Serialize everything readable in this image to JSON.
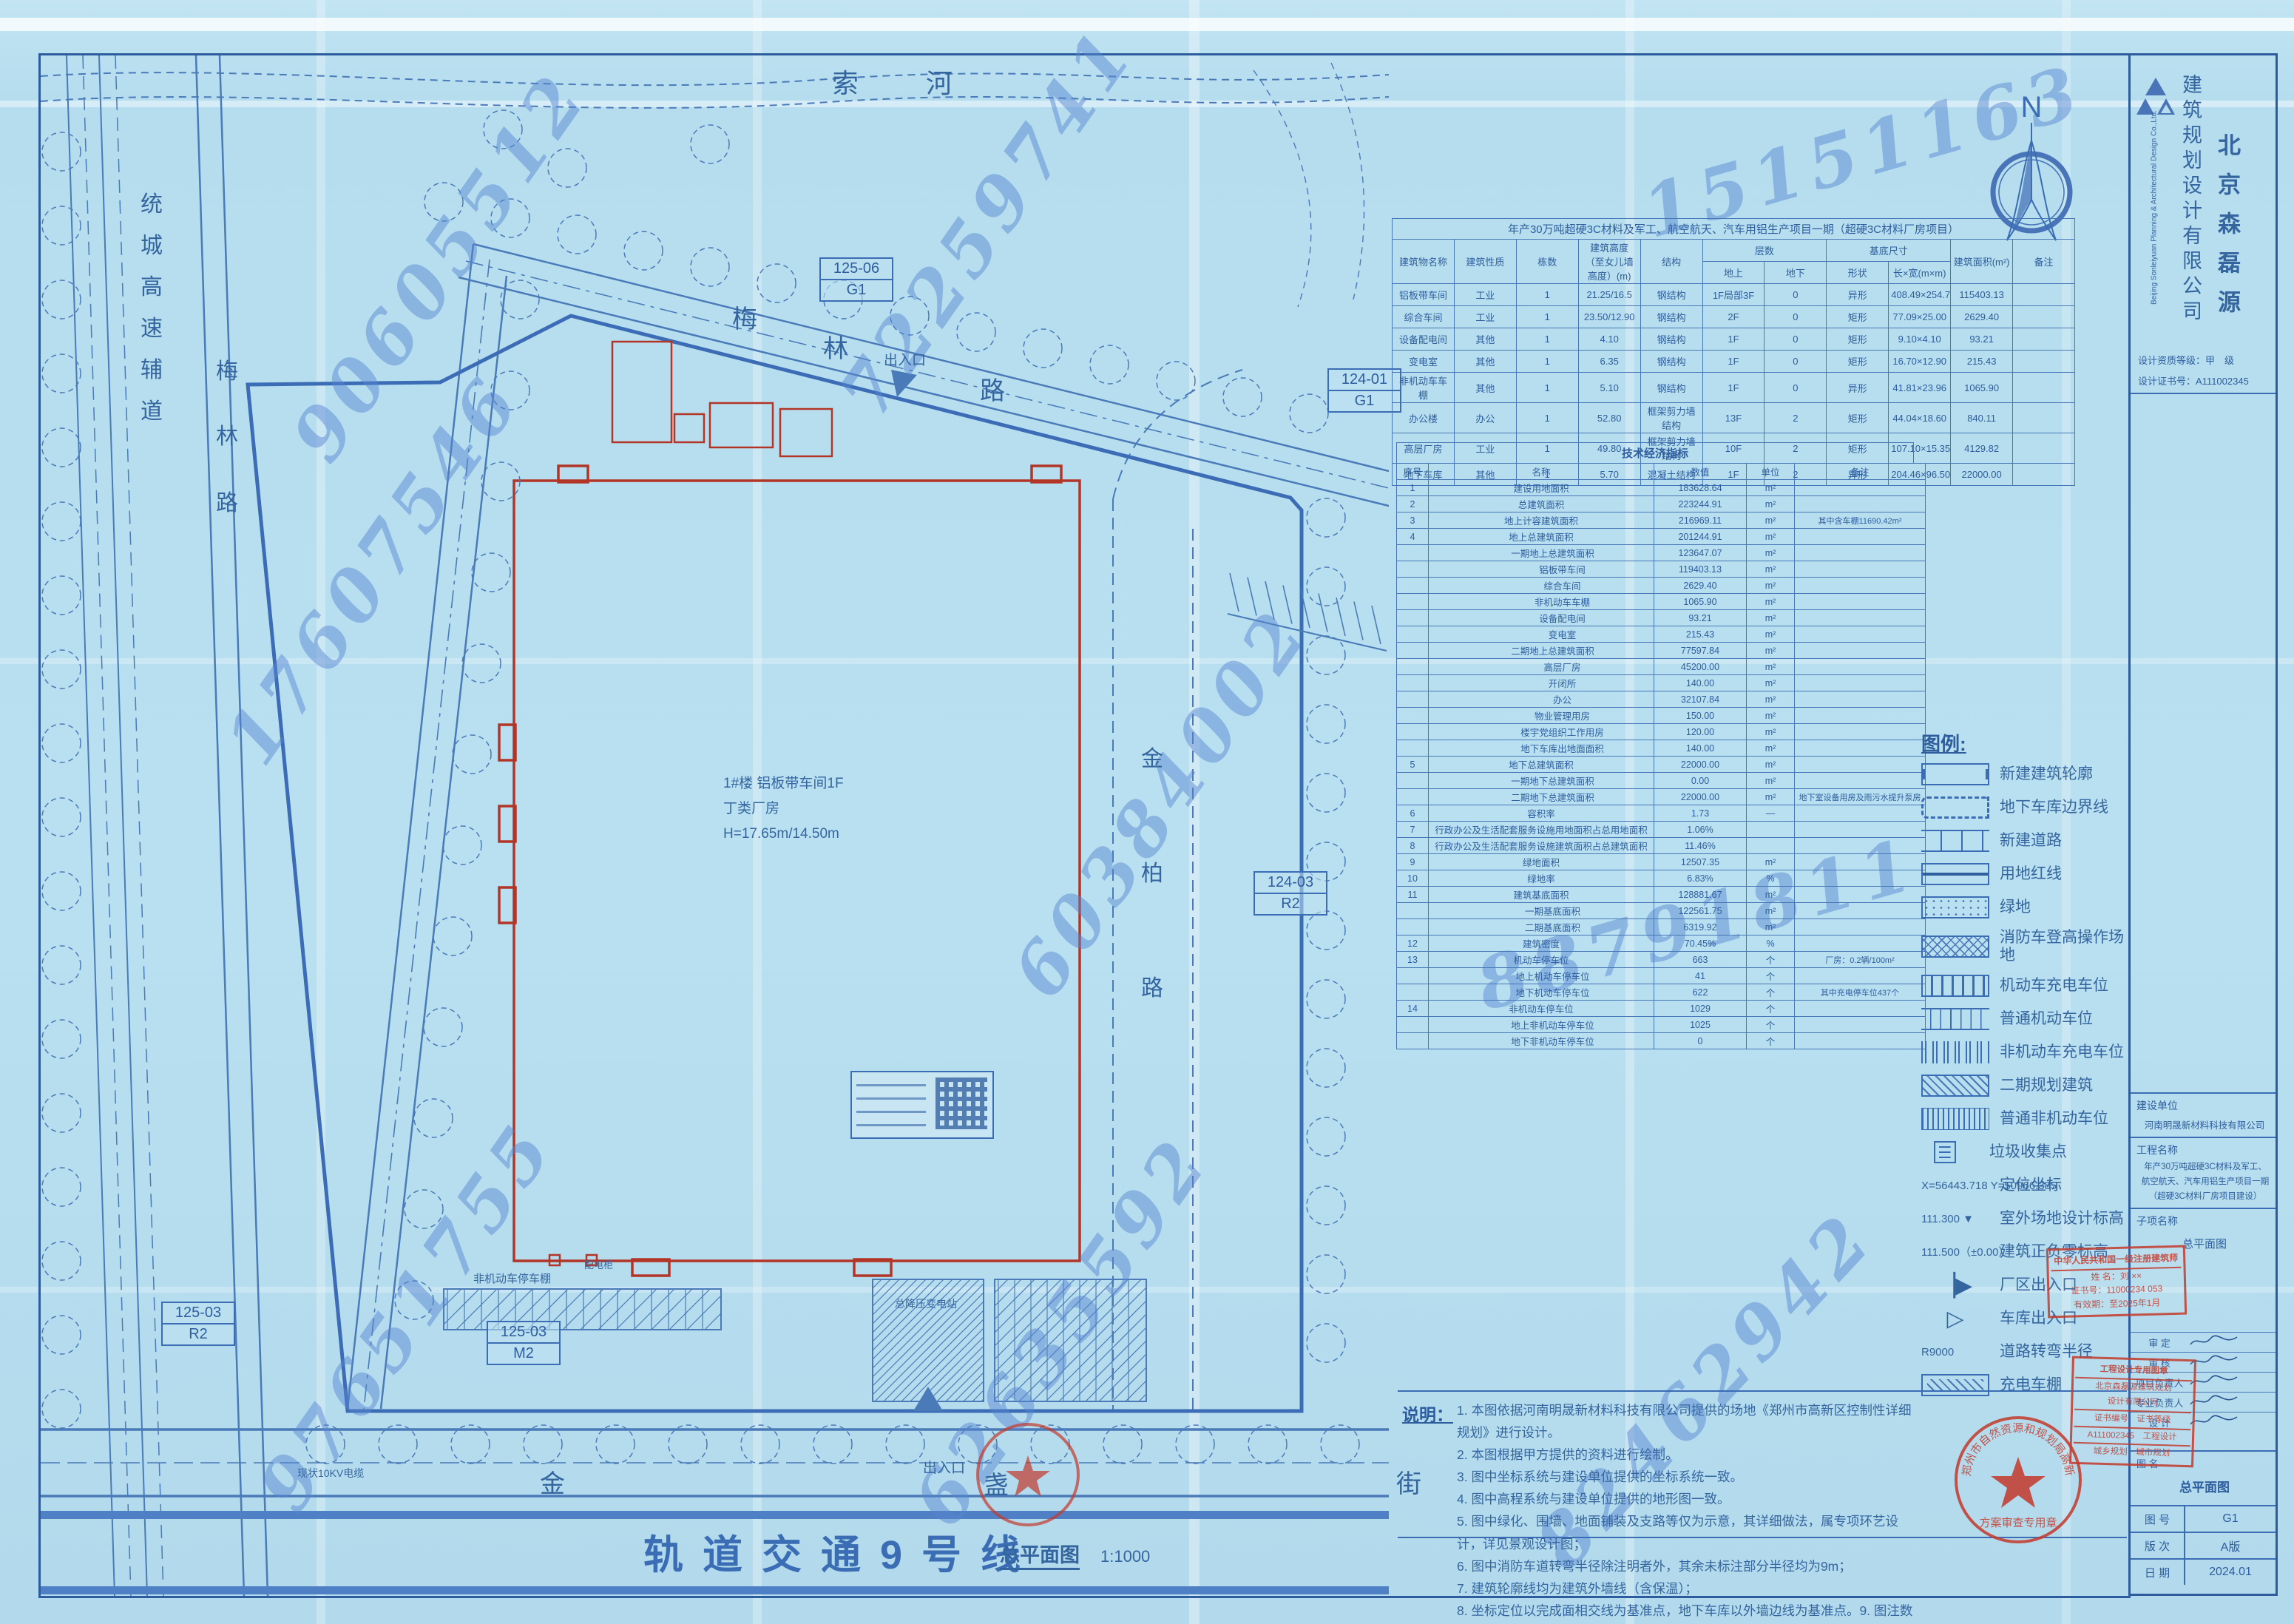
{
  "colors": {
    "ink": "#2e5d9e",
    "line": "#3a6db4",
    "red_outline": "#b23527",
    "stamp_red": "#c43a2c",
    "paper": "#b6ddee",
    "watermark": "#5885d0"
  },
  "sheet": {
    "north": "N",
    "rail_label": "轨道交通9号线",
    "scale_label": "总平面图",
    "scale_value": "1:1000"
  },
  "roads": {
    "river": [
      "索",
      "河"
    ],
    "meilin_top": [
      "梅",
      "林",
      "路"
    ],
    "tongcheng": [
      "统",
      "城",
      "高",
      "速",
      "辅",
      "道"
    ],
    "meilin_left": [
      "梅",
      "林",
      "路"
    ],
    "jinbai": [
      "金",
      "柏",
      "路"
    ],
    "jinzhan": [
      "金",
      "盏",
      "街"
    ],
    "gate_label": "出入口",
    "shed_label": "非机动车停车棚",
    "pdg_label": "配电柜",
    "substation_label": "总降压变电站",
    "cable_label": "现状10KV电缆"
  },
  "grid_refs": [
    {
      "code": "125-06",
      "zone": "G1"
    },
    {
      "code": "124-01",
      "zone": "G1"
    },
    {
      "code": "124-03",
      "zone": "R2"
    },
    {
      "code": "125-03",
      "zone": "M2"
    },
    {
      "code": "125-03",
      "zone": "R2"
    }
  ],
  "main_building": {
    "line1": "1#楼 铝板带车间1F",
    "line2": "丁类厂房",
    "line3": "H=17.65m/14.50m"
  },
  "watermarks": [
    "90605512",
    "72259741",
    "15151163",
    "17607546",
    "60384002",
    "88791811",
    "97651755",
    "62635592",
    "82462942"
  ],
  "buildings_table": {
    "title": "年产30万吨超硬3C材料及军工、航空航天、汽车用铝生产项目一期（超硬3C材料厂房项目）",
    "head_top": [
      "建筑物名称",
      "建筑性质",
      "栋数",
      "建筑高度（至女儿墙高度）(m)",
      "结构",
      "层数",
      "基底尺寸",
      "建筑面积(m²)",
      "备注"
    ],
    "head_sub": [
      "地上",
      "地下",
      "形状",
      "长×宽(m×m)"
    ],
    "rows": [
      [
        "铝板带车间",
        "工业",
        "1",
        "21.25/16.5",
        "钢结构",
        "1F局部3F",
        "0",
        "异形",
        "408.49×254.78",
        "115403.13",
        ""
      ],
      [
        "综合车间",
        "工业",
        "1",
        "23.50/12.90",
        "钢结构",
        "2F",
        "0",
        "矩形",
        "77.09×25.00",
        "2629.40",
        ""
      ],
      [
        "设备配电间",
        "其他",
        "1",
        "4.10",
        "钢结构",
        "1F",
        "0",
        "矩形",
        "9.10×4.10",
        "93.21",
        ""
      ],
      [
        "变电室",
        "其他",
        "1",
        "6.35",
        "钢结构",
        "1F",
        "0",
        "矩形",
        "16.70×12.90",
        "215.43",
        ""
      ],
      [
        "非机动车车棚",
        "其他",
        "1",
        "5.10",
        "钢结构",
        "1F",
        "0",
        "异形",
        "41.81×23.96",
        "1065.90",
        ""
      ],
      [
        "办公楼",
        "办公",
        "1",
        "52.80",
        "框架剪力墙结构",
        "13F",
        "2",
        "矩形",
        "44.04×18.60",
        "840.11",
        ""
      ],
      [
        "高层厂房",
        "工业",
        "1",
        "49.80",
        "框架剪力墙结构",
        "10F",
        "2",
        "矩形",
        "107.10×15.35",
        "4129.82",
        ""
      ],
      [
        "地下车库",
        "其他",
        "1",
        "5.70",
        "混凝土结构",
        "1F",
        "2",
        "异形",
        "204.46×96.50",
        "22000.00",
        ""
      ]
    ]
  },
  "indicators_table": {
    "title": "技术经济指标",
    "headers": [
      "序号",
      "名称",
      "数值",
      "单位",
      "备注"
    ],
    "rows": [
      [
        "1",
        "建设用地面积",
        "183628.64",
        "m²",
        "",
        0
      ],
      [
        "2",
        "总建筑面积",
        "223244.91",
        "m²",
        "",
        0
      ],
      [
        "3",
        "地上计容建筑面积",
        "216969.11",
        "m²",
        "其中含车棚11690.42m²",
        0
      ],
      [
        "4",
        "地上总建筑面积",
        "201244.91",
        "m²",
        "",
        0
      ],
      [
        "",
        "一期地上总建筑面积",
        "123647.07",
        "m²",
        "",
        1
      ],
      [
        "",
        "铝板带车间",
        "119403.13",
        "m²",
        "",
        2
      ],
      [
        "",
        "综合车间",
        "2629.40",
        "m²",
        "",
        2
      ],
      [
        "",
        "非机动车车棚",
        "1065.90",
        "m²",
        "",
        2
      ],
      [
        "",
        "设备配电间",
        "93.21",
        "m²",
        "",
        2
      ],
      [
        "",
        "变电室",
        "215.43",
        "m²",
        "",
        2
      ],
      [
        "",
        "二期地上总建筑面积",
        "77597.84",
        "m²",
        "",
        1
      ],
      [
        "",
        "高层厂房",
        "45200.00",
        "m²",
        "",
        2
      ],
      [
        "",
        "开闭所",
        "140.00",
        "m²",
        "",
        2
      ],
      [
        "",
        "办公",
        "32107.84",
        "m²",
        "",
        2
      ],
      [
        "",
        "物业管理用房",
        "150.00",
        "m²",
        "",
        2
      ],
      [
        "",
        "楼宇党组织工作用房",
        "120.00",
        "m²",
        "",
        2
      ],
      [
        "",
        "地下车库出地面面积",
        "140.00",
        "m²",
        "",
        2
      ],
      [
        "5",
        "地下总建筑面积",
        "22000.00",
        "m²",
        "",
        0
      ],
      [
        "",
        "一期地下总建筑面积",
        "0.00",
        "m²",
        "",
        1
      ],
      [
        "",
        "二期地下总建筑面积",
        "22000.00",
        "m²",
        "地下室设备用房及雨污水提升泵房",
        1
      ],
      [
        "6",
        "容积率",
        "1.73",
        "—",
        "",
        0
      ],
      [
        "7",
        "行政办公及生活配套服务设施用地面积占总用地面积",
        "1.06%",
        "",
        "",
        0
      ],
      [
        "8",
        "行政办公及生活配套服务设施建筑面积占总建筑面积",
        "11.46%",
        "",
        "",
        0
      ],
      [
        "9",
        "绿地面积",
        "12507.35",
        "m²",
        "",
        0
      ],
      [
        "10",
        "绿地率",
        "6.83%",
        "%",
        "",
        0
      ],
      [
        "11",
        "建筑基底面积",
        "128881.67",
        "m²",
        "",
        0
      ],
      [
        "",
        "一期基底面积",
        "122561.75",
        "m²",
        "",
        1
      ],
      [
        "",
        "二期基底面积",
        "6319.92",
        "m²",
        "",
        1
      ],
      [
        "12",
        "建筑密度",
        "70.45%",
        "%",
        "",
        0
      ],
      [
        "13",
        "机动车停车位",
        "663",
        "个",
        "厂房：0.2辆/100m²",
        0
      ],
      [
        "",
        "地上机动车停车位",
        "41",
        "个",
        "",
        1
      ],
      [
        "",
        "地下机动车停车位",
        "622",
        "个",
        "其中充电停车位437个",
        1
      ],
      [
        "14",
        "非机动车停车位",
        "1029",
        "个",
        "",
        0
      ],
      [
        "",
        "地上非机动车停车位",
        "1025",
        "个",
        "",
        1
      ],
      [
        "",
        "地下非机动车停车位",
        "0",
        "个",
        "",
        1
      ]
    ]
  },
  "legend": {
    "title": "图例:",
    "items": [
      {
        "sym": "s-outline",
        "label": "新建建筑轮廓",
        "symtext": ""
      },
      {
        "sym": "s-dash",
        "label": "地下车库边界线",
        "symtext": ""
      },
      {
        "sym": "s-road",
        "label": "新建道路",
        "symtext": ""
      },
      {
        "sym": "s-red",
        "label": "用地红线",
        "symtext": ""
      },
      {
        "sym": "s-green",
        "label": "绿地",
        "symtext": ""
      },
      {
        "sym": "s-cross",
        "label": "消防车登高操作场地",
        "symtext": ""
      },
      {
        "sym": "s-charge",
        "label": "机动车充电车位",
        "symtext": ""
      },
      {
        "sym": "s-stall",
        "label": "普通机动车位",
        "symtext": ""
      },
      {
        "sym": "s-nmc",
        "label": "非机动车充电车位",
        "symtext": ""
      },
      {
        "sym": "s-hatch",
        "label": "二期规划建筑",
        "symtext": ""
      },
      {
        "sym": "s-nm",
        "label": "普通非机动车位",
        "symtext": ""
      },
      {
        "sym": "s-trash",
        "label": "垃圾收集点",
        "symtext": ""
      },
      {
        "sym": "s-text",
        "label": "定位坐标",
        "symtext": "X=56443.718  Y=50966.385"
      },
      {
        "sym": "s-text",
        "label": "室外场地设计标高",
        "symtext": "111.300 ▼"
      },
      {
        "sym": "s-text",
        "label": "建筑正负零标高",
        "symtext": "111.500（±0.00）"
      },
      {
        "sym": "s-gate",
        "label": "厂区出入口",
        "symtext": "▕▶"
      },
      {
        "sym": "s-gate",
        "label": "车库出入口",
        "symtext": "▷"
      },
      {
        "sym": "s-text",
        "label": "道路转弯半径",
        "symtext": "R9000"
      },
      {
        "sym": "s-shed",
        "label": "充电车棚",
        "symtext": ""
      }
    ]
  },
  "notes": {
    "title": "说明：",
    "items": [
      "本图依据河南明晟新材料科技有限公司提供的场地《郑州市高新区控制性详细规划》进行设计。",
      "本图根据甲方提供的资料进行绘制。",
      "图中坐标系统与建设单位提供的坐标系统一致。",
      "图中高程系统与建设单位提供的地形图一致。",
      "图中绿化、围墙、地面铺装及支路等仅为示意，其详细做法，属专项环艺设计，详见景观设计图；",
      "图中消防车道转弯半径除注明者外，其余未标注部分半径均为9m；",
      "建筑轮廓线均为建筑外墙线（含保温）；",
      "坐标定位以完成面相交线为基准点，地下车库以外墙边线为基准点。9. 图注数据以米为单位。"
    ]
  },
  "title_block": {
    "company_cn_col1": "建筑规划设计有限公司",
    "company_cn_col2": "北京森磊源",
    "company_en": "Beijing Sonleiyuan Planning & Architectural Design Co.,Ltd.",
    "grade": "设计资质等级：甲　级",
    "cert_no": "设计证书号：A111002345",
    "owner_label": "建设单位",
    "owner": "河南明晟新材料科技有限公司",
    "project_label": "工程名称",
    "project_lines": [
      "年产30万吨超硬3C材料及军工、",
      "航空航天、汽车用铝生产项目一期",
      "（超硬3C材料厂房项目建设）"
    ],
    "subproject_label": "子项名称",
    "drawing_label": "图 名",
    "drawing_name": "总平面图",
    "sign_rows": [
      "审 定",
      "审 核",
      "项目负责人",
      "专业负责人",
      "设 计"
    ],
    "meta_rows": [
      {
        "label": "图 号",
        "value": "G1"
      },
      {
        "label": "版 次",
        "value": "A版"
      },
      {
        "label": "日 期",
        "value": "2024.01"
      }
    ]
  },
  "stamps": {
    "registered": {
      "lines": [
        "中华人民共和国一级注册建筑师",
        "姓 名：刘 ××",
        "证书号：11000234 053",
        "有效期：至2025年1月"
      ]
    },
    "design_seal": {
      "lines": [
        "工程设计专用图章",
        "北京森磊源建筑规划",
        "设计有限公司",
        "证书编号　证书等级",
        "A111002345　工程设计",
        "城乡规划　城市规划"
      ]
    },
    "review": {
      "arc": "郑州市自然资源和规划局高新分局",
      "center": "方案审查专用章"
    }
  }
}
